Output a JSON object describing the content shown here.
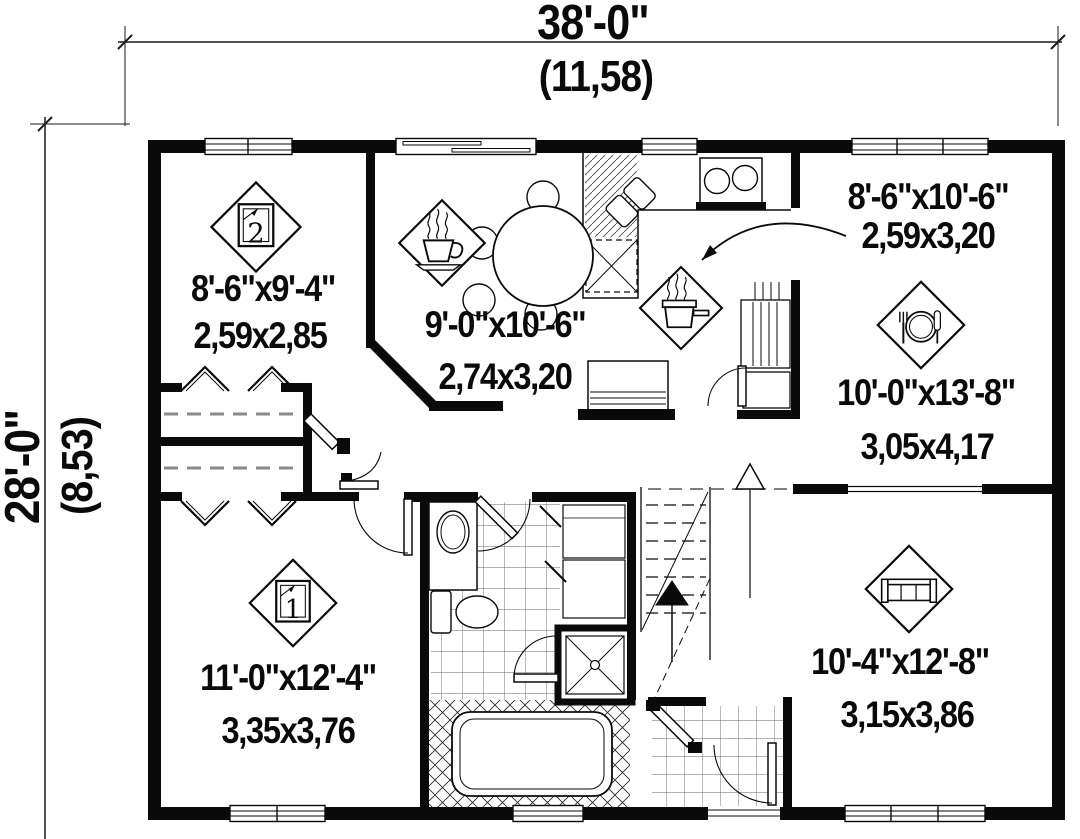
{
  "overall": {
    "width_ft": "38'-0\"",
    "width_m": "(11,58)",
    "depth_ft": "28'-0\"",
    "depth_m": "(8,53)"
  },
  "rooms": [
    {
      "name": "bedroom-2",
      "icon": "bed-icon",
      "badge": "2",
      "size_ft": "8'-6\"x9'-4\"",
      "size_m": "2,59x2,85"
    },
    {
      "name": "dinette",
      "icon": "coffee-cup-icon",
      "size_ft": "9'-0\"x10'-6\"",
      "size_m": "2,74x3,20"
    },
    {
      "name": "kitchen",
      "icon": "cooking-pot-icon",
      "size_ft": "8'-6\"x10'-6\"",
      "size_m": "2,59x3,20"
    },
    {
      "name": "dining-room",
      "icon": "place-setting-icon",
      "size_ft": "10'-0\"x13'-8\"",
      "size_m": "3,05x4,17"
    },
    {
      "name": "bedroom-1",
      "icon": "bed-icon",
      "badge": "1",
      "size_ft": "11'-0\"x12'-4\"",
      "size_m": "3,35x3,76"
    },
    {
      "name": "living-room",
      "icon": "sofa-icon",
      "size_ft": "10'-4\"x12'-8\"",
      "size_m": "3,15x3,86"
    }
  ],
  "colors": {
    "ink": "#0a0a0a",
    "paper": "#ffffff",
    "dash_gray": "#8a8a8a"
  }
}
